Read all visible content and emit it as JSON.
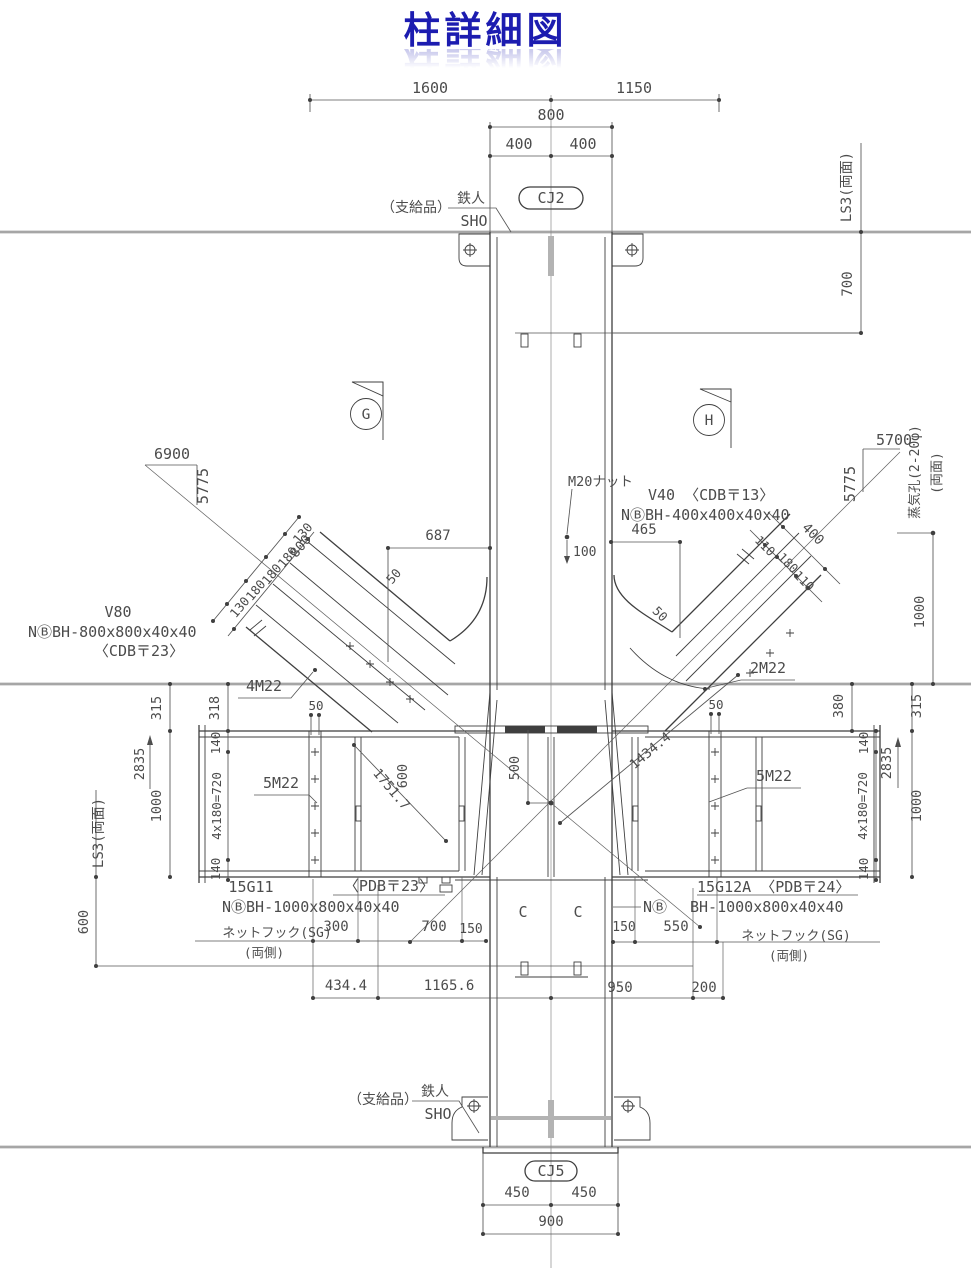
{
  "title": "柱詳細図",
  "colors": {
    "title_blue": "#1c1cb0",
    "line": "#3f3f3f",
    "dim_text": "#4c4c4c",
    "floor": "#a6a6a6"
  },
  "top": {
    "d1600": "1600",
    "d1150": "1150",
    "d800": "800",
    "d400l": "400",
    "d400r": "400",
    "cj2": "CJ2",
    "supply": "（支給品）",
    "maker": "鉄人",
    "maker_sub": "SHO",
    "ls3": "LS3(両面)",
    "d700": "700"
  },
  "marks": {
    "g": "G",
    "h": "H"
  },
  "slope_left": {
    "run": "6900",
    "rise": "5775"
  },
  "slope_right": {
    "run": "5700",
    "rise": "5775"
  },
  "vent": {
    "label": "蒸気孔(2-20φ)",
    "side": "(両面)",
    "d1000": "1000"
  },
  "mid": {
    "m20": "M20ナット",
    "d100": "100",
    "d465": "465",
    "d687": "687"
  },
  "v40": {
    "name_plate": "V40 〈CDB〒13〉",
    "size": "NⒷBH-400x400x40x40"
  },
  "v80": {
    "name": "V80",
    "size": "NⒷBH-800x800x40x40",
    "plate": "〈CDB〒23〉"
  },
  "brace_left": {
    "overall": "800",
    "segs": [
      "130",
      "180",
      "180",
      "180",
      "130"
    ],
    "edge": "50"
  },
  "brace_right": {
    "overall": "400",
    "segs": [
      "110",
      "180",
      "110"
    ],
    "edge": "50"
  },
  "joint": {
    "m4": "4M22",
    "m2": "2M22",
    "d50l": "50",
    "d50r": "50",
    "d500": "500",
    "d600": "600",
    "diag_l": "1751.7",
    "diag_r": "1434.4"
  },
  "dims_left": {
    "d315": "315",
    "d318": "318",
    "d2835": "2835",
    "d140t": "140",
    "d720": "4x180=720",
    "d140b": "140",
    "d1000": "1000",
    "ls3": "LS3(両面)",
    "d600": "600"
  },
  "dims_right": {
    "d380": "380",
    "d315": "315",
    "d2835": "2835",
    "d140t": "140",
    "d720": "4x180=720",
    "d140b": "140",
    "d1000": "1000"
  },
  "girder_left": {
    "name": "15G11",
    "plate": "〈PDB〒23〉",
    "size": "NⒷBH-1000x800x40x40",
    "bolts": "5M22",
    "hook": "ネットフック(SG)",
    "hook_side": "(両側)",
    "d300": "300",
    "d700": "700",
    "d150": "150"
  },
  "girder_right": {
    "name_plate": "15G12A 〈PDB〒24〉",
    "size": "BH-1000x800x40x40",
    "n_mark": "NⒷ",
    "bolts": "5M22",
    "hook": "ネットフック(SG)",
    "hook_side": "(両側)",
    "d150": "150",
    "d550": "550"
  },
  "bottom": {
    "d434": "434.4",
    "d1165": "1165.6",
    "d950": "950",
    "d200": "200",
    "c_left": "C",
    "c_right": "C",
    "cj5": "CJ5",
    "d450l": "450",
    "d450r": "450",
    "d900": "900",
    "supply": "（支給品）",
    "maker": "鉄人",
    "maker_sub": "SHO"
  }
}
